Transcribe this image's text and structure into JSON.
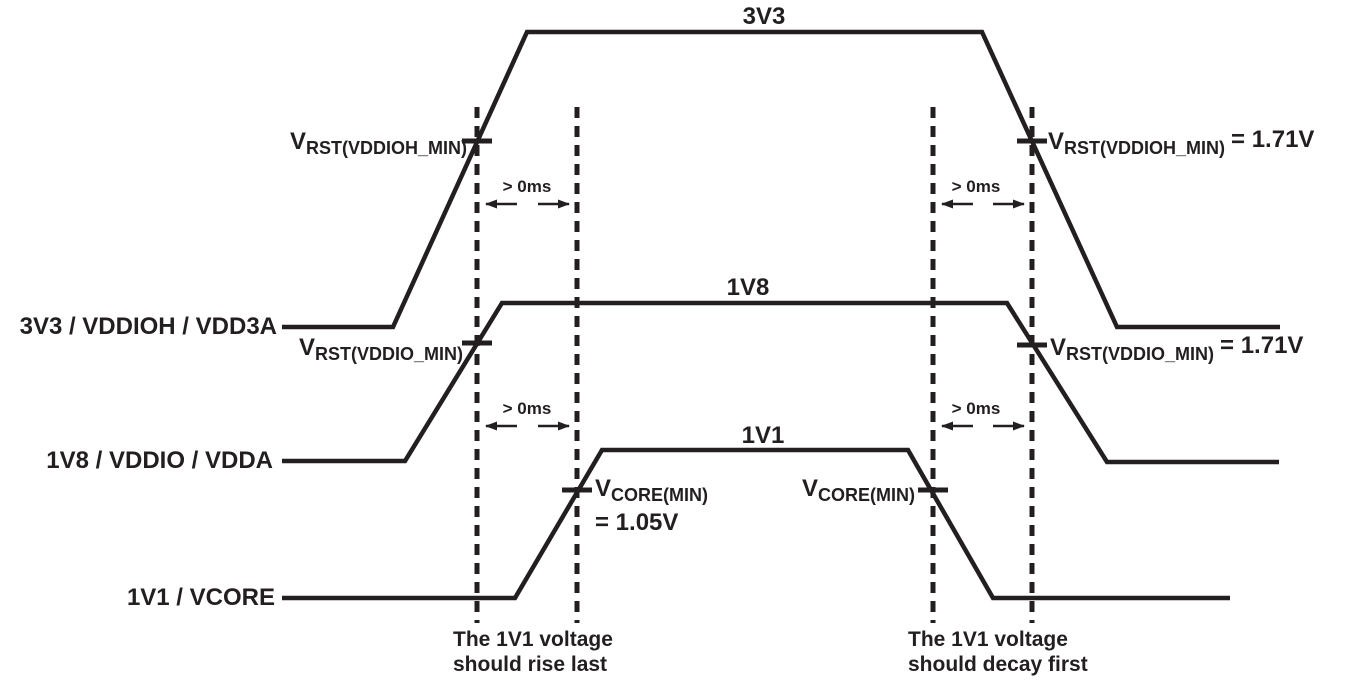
{
  "diagram": {
    "colors": {
      "ink": "#231f20",
      "background": "#ffffff"
    },
    "rails": [
      {
        "id": "3v3",
        "label": "3V3 / VDDIOH / VDD3A",
        "level_label": "3V3"
      },
      {
        "id": "1v8",
        "label": "1V8 / VDDIO / VDDA",
        "level_label": "1V8"
      },
      {
        "id": "1v1",
        "label": "1V1 / VCORE",
        "level_label": "1V1"
      }
    ],
    "thresholds": {
      "rise_vddioh": {
        "prefix": "V",
        "sub": "RST(VDDIOH_MIN)",
        "suffix": ""
      },
      "rise_vddio": {
        "prefix": "V",
        "sub": "RST(VDDIO_MIN)",
        "suffix": ""
      },
      "rise_vcore": {
        "prefix": "V",
        "sub": "CORE(MIN)",
        "value_line": "= 1.05V"
      },
      "fall_vcore": {
        "prefix": "V",
        "sub": "CORE(MIN)"
      },
      "fall_vddioh": {
        "prefix": "V",
        "sub": "RST(VDDIOH_MIN)",
        "suffix": "= 1.71V"
      },
      "fall_vddio": {
        "prefix": "V",
        "sub": "RST(VDDIO_MIN)",
        "suffix": "= 1.71V"
      }
    },
    "timing_label": "> 0ms",
    "notes": {
      "rise": [
        "The 1V1 voltage",
        "should rise last"
      ],
      "fall": [
        "The 1V1 voltage",
        "should decay first"
      ]
    }
  }
}
